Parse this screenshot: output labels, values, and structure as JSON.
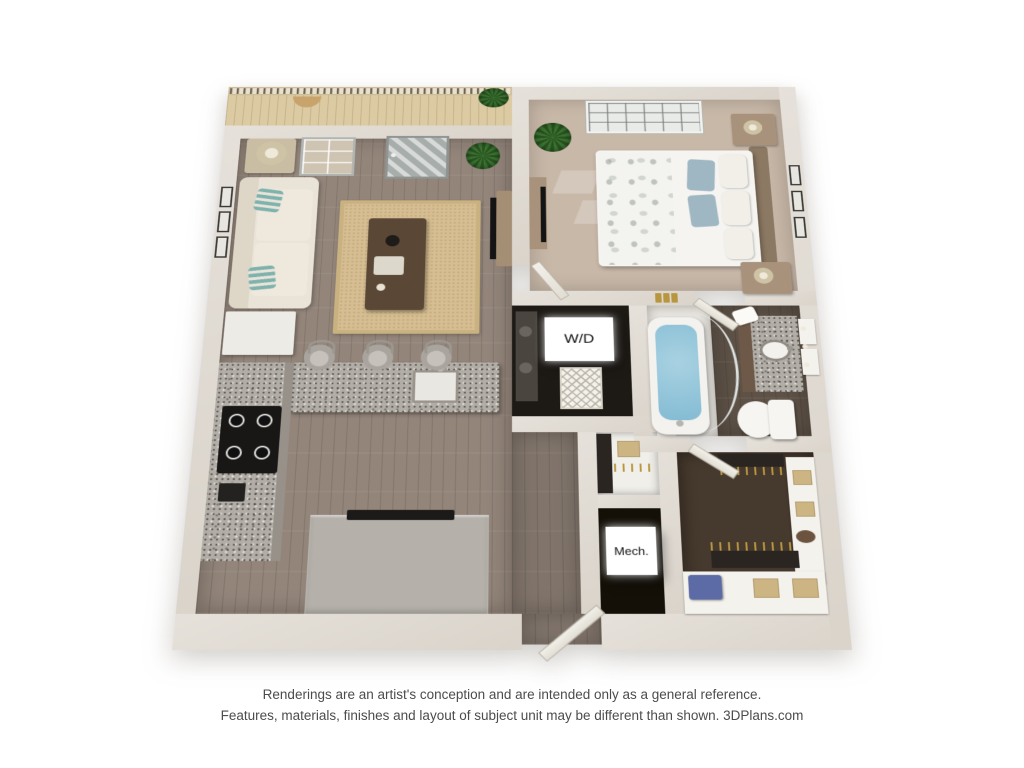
{
  "labels": {
    "washer_dryer": "W/D",
    "mechanical": "Mech."
  },
  "caption": {
    "line1": "Renderings are an artist's conception and are intended only as a general reference.",
    "line2": "Features, materials, finishes and layout of subject unit may be different than shown. 3DPlans.com"
  },
  "colors": {
    "wall": "#dad4cb",
    "wallHi": "#e6e1da",
    "wallEdge": "#c2bbae",
    "wood": "#93857a",
    "carpetBed": "#c8b8a8",
    "balconyFloor": "#dbcaa2",
    "railBase": "#e9e1cd",
    "slat": "#6d6152",
    "rug": "#d6be92",
    "sofa": "#eae4d8",
    "cushion": "#efe9dd",
    "pillowTeal": "#7fb2ad",
    "granite": "#b2aea7",
    "cabinetGray": "#97918a",
    "cooktop": "#181715",
    "fridge": "#edebe6",
    "water": "#84bcd4",
    "tubShell": "#f3f2ee",
    "bathWood": "#5e5247",
    "vanityWood": "#6e5948",
    "toiletWhite": "#f6f5f2",
    "darkRoom": "#1d1915",
    "mechDark": "#141008",
    "closetCarpet": "#46392d",
    "shelfWhite": "#f4f2ec",
    "boxTan": "#cdb483",
    "binBlue": "#5c6aa5",
    "clothesDark": "#2b2522",
    "gold": "#b8963f",
    "door": "#f2f0e9",
    "glassDoor": "#a7adaa",
    "headboard": "#8c7963",
    "nightstand": "#a8927b",
    "tableWood": "#5a4736",
    "consoleWood": "#a48e74",
    "tvBlack": "#141414",
    "plantGreen": "#3a7030",
    "plantDark": "#27511f",
    "caption": "#4c4c4c",
    "labelText": "#111111",
    "labelBg": "#ffffff"
  }
}
